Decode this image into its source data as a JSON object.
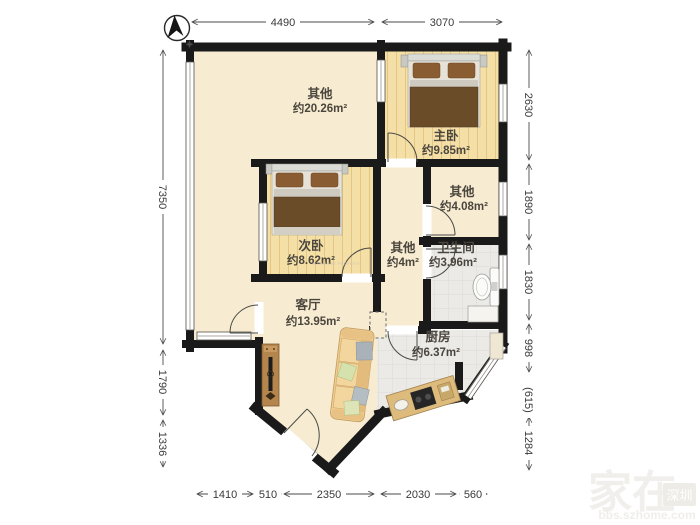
{
  "compass": {
    "icon": "north-arrow"
  },
  "rooms": [
    {
      "name": "其他",
      "area": "约20.26m²"
    },
    {
      "name": "主卧",
      "area": "约9.85m²"
    },
    {
      "name": "其他",
      "area": "约4.08m²"
    },
    {
      "name": "次卧",
      "area": "约8.62m²"
    },
    {
      "name": "其他",
      "area": "约4m²"
    },
    {
      "name": "卫生间",
      "area": "约3.96m²"
    },
    {
      "name": "客厅",
      "area": "约13.95m²"
    },
    {
      "name": "厨房",
      "area": "约6.37m²"
    }
  ],
  "dimensions": {
    "top": [
      "4490",
      "3070"
    ],
    "left": [
      "7350",
      "1790",
      "1336"
    ],
    "right": [
      "2630",
      "1890",
      "1830",
      "998",
      "(615)",
      "1284"
    ],
    "bottom": [
      "1410",
      "510",
      "2350",
      "2030",
      "560"
    ]
  },
  "watermarks": {
    "brand": "家在",
    "badge": "深圳",
    "site": "bbs.szhome.com",
    "property_mark": "CDEKAUSE PROPERTY"
  },
  "colors": {
    "wall": "#1a1a1a",
    "dimension": "#4a4a4a",
    "floor_marble": "#f7ecd1",
    "floor_wood": "#f4dfa6",
    "floor_tile": "#ebeae7",
    "furniture_brown": "#6b4c28"
  }
}
